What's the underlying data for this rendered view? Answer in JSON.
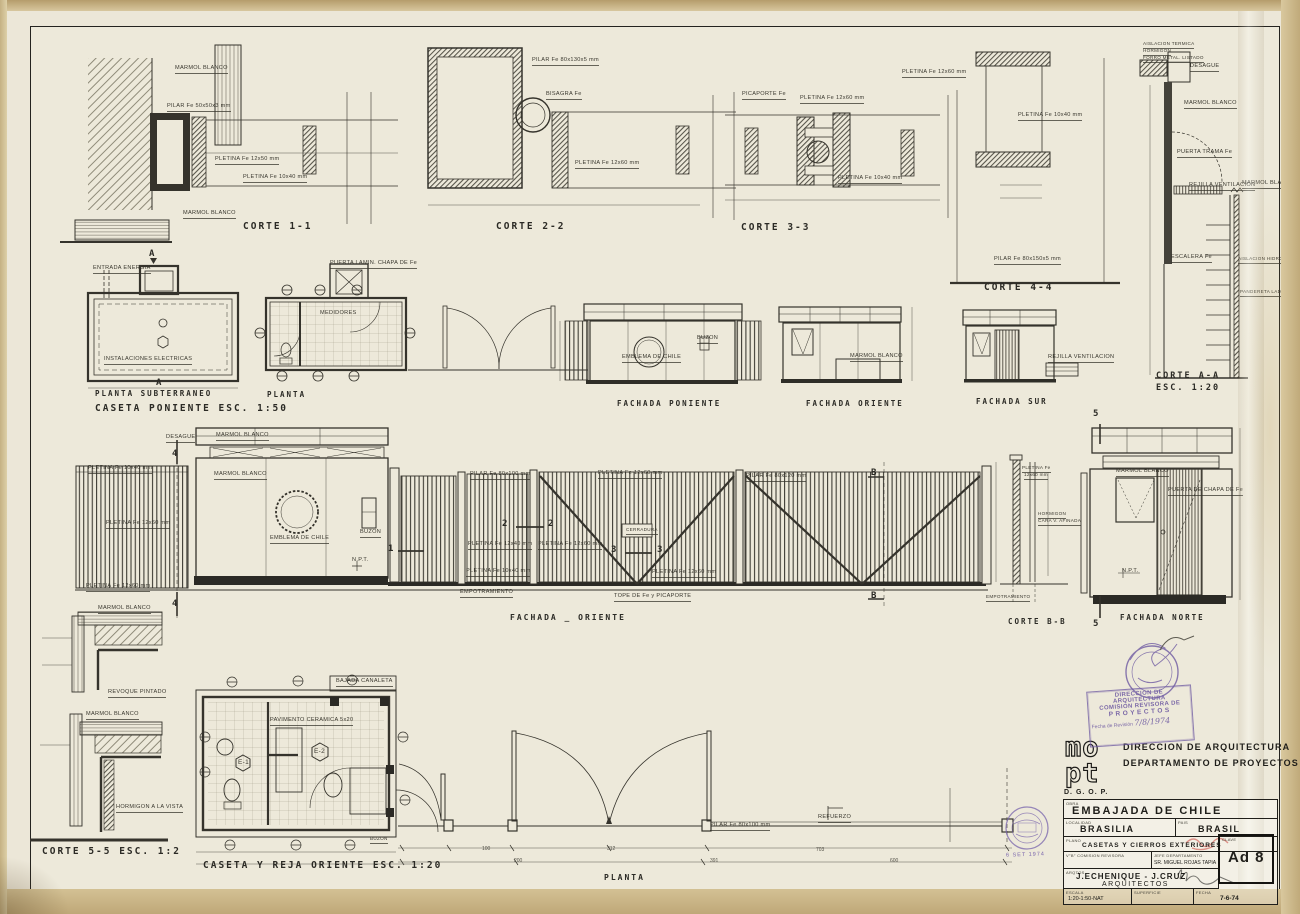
{
  "sheet": {
    "titles": [
      {
        "text": "CORTE 1-1",
        "x": 243,
        "y": 222
      },
      {
        "text": "CORTE 2-2",
        "x": 496,
        "y": 222
      },
      {
        "text": "CORTE 3-3",
        "x": 741,
        "y": 223
      },
      {
        "text": "CORTE 4-4",
        "x": 984,
        "y": 283
      },
      {
        "text": "CORTE A-A",
        "x": 1156,
        "y": 372,
        "size": 8.5
      },
      {
        "text": "ESC. 1:20",
        "x": 1156,
        "y": 384,
        "size": 8.5
      },
      {
        "text": "PLANTA SUBTERRANEO",
        "x": 95,
        "y": 390,
        "size": 7.5
      },
      {
        "text": "CASETA PONIENTE   ESC. 1:50",
        "x": 95,
        "y": 404
      },
      {
        "text": "PLANTA",
        "x": 267,
        "y": 391,
        "size": 7.5
      },
      {
        "text": "FACHADA PONIENTE",
        "x": 617,
        "y": 400,
        "size": 7.5
      },
      {
        "text": "FACHADA ORIENTE",
        "x": 806,
        "y": 400,
        "size": 7.5
      },
      {
        "text": "FACHADA SUR",
        "x": 976,
        "y": 398,
        "size": 7.5
      },
      {
        "text": "FACHADA _ ORIENTE",
        "x": 510,
        "y": 614,
        "size": 8
      },
      {
        "text": "CORTE B-B",
        "x": 1008,
        "y": 618,
        "size": 7.5
      },
      {
        "text": "FACHADA NORTE",
        "x": 1120,
        "y": 614,
        "size": 7.5
      },
      {
        "text": "CORTE 5-5  ESC. 1:2",
        "x": 42,
        "y": 847
      },
      {
        "text": "CASETA Y REJA ORIENTE   ESC. 1:20",
        "x": 203,
        "y": 861
      },
      {
        "text": "PLANTA",
        "x": 604,
        "y": 874,
        "size": 8
      }
    ],
    "annotations": [
      {
        "text": "MARMOL BLANCO",
        "x": 175,
        "y": 66
      },
      {
        "text": "PILAR Fe 50x50x3 mm",
        "x": 167,
        "y": 104
      },
      {
        "text": "PLETINA Fe 12x50 mm",
        "x": 215,
        "y": 157
      },
      {
        "text": "PLETINA Fe 10x40 mm",
        "x": 243,
        "y": 175
      },
      {
        "text": "MARMOL BLANCO",
        "x": 183,
        "y": 211
      },
      {
        "text": "PILAR Fe 80x130x5 mm",
        "x": 532,
        "y": 58
      },
      {
        "text": "BISAGRA Fe",
        "x": 546,
        "y": 92
      },
      {
        "text": "PLETINA Fe 12x60 mm",
        "x": 575,
        "y": 161
      },
      {
        "text": "PICAPORTE Fe",
        "x": 742,
        "y": 92
      },
      {
        "text": "PLETINA Fe 12x60 mm",
        "x": 800,
        "y": 96
      },
      {
        "text": "PLETINA Fe 10x40 mm",
        "x": 838,
        "y": 176
      },
      {
        "text": "PLETINA Fe 12x60 mm",
        "x": 902,
        "y": 70
      },
      {
        "text": "PLETINA Fe 10x40 mm",
        "x": 1018,
        "y": 113
      },
      {
        "text": "PILAR Fe 80x150x5 mm",
        "x": 994,
        "y": 257
      },
      {
        "text": "AISLACION TERMICA",
        "x": 1143,
        "y": 42,
        "size": 4.6
      },
      {
        "text": "HORMIGON",
        "x": 1143,
        "y": 49,
        "size": 4.6
      },
      {
        "text": "FORRO METAL. LISTADO",
        "x": 1143,
        "y": 56,
        "size": 4.6
      },
      {
        "text": "DESAGUE",
        "x": 1190,
        "y": 64
      },
      {
        "text": "MARMOL BLANCO",
        "x": 1184,
        "y": 101
      },
      {
        "text": "PUERTA TRAMA Fe",
        "x": 1177,
        "y": 150
      },
      {
        "text": "REJILLA VENTILACION",
        "x": 1189,
        "y": 183
      },
      {
        "text": "MARMOL BLANCO",
        "x": 1242,
        "y": 181
      },
      {
        "text": "ESCALERA Fe",
        "x": 1171,
        "y": 255
      },
      {
        "text": "AISLACION HIDROFUGA",
        "x": 1238,
        "y": 257,
        "size": 4.6
      },
      {
        "text": "PANDERETA LADRILLO",
        "x": 1240,
        "y": 290,
        "size": 4.6
      },
      {
        "text": "ENTRADA ENERGIA",
        "x": 93,
        "y": 266
      },
      {
        "text": "INSTALACIONES ELECTRICAS",
        "x": 104,
        "y": 357
      },
      {
        "text": "PUERTA LAMIN. CHAPA DE Fe",
        "x": 330,
        "y": 261
      },
      {
        "text": "MEDIDORES",
        "x": 320,
        "y": 311,
        "u": 0
      },
      {
        "text": "EMBLEMA DE CHILE",
        "x": 622,
        "y": 355
      },
      {
        "text": "BUZON",
        "x": 697,
        "y": 336
      },
      {
        "text": "MARMOL BLANCO",
        "x": 850,
        "y": 354
      },
      {
        "text": "REJILLA VENTILACION",
        "x": 1048,
        "y": 355
      },
      {
        "text": "DESAGUE",
        "x": 166,
        "y": 435
      },
      {
        "text": "MARMOL BLANCO",
        "x": 216,
        "y": 433
      },
      {
        "text": "PLETINA Fe 10x40 mm",
        "x": 88,
        "y": 466
      },
      {
        "text": "PLETINA Fe 12x60 mm",
        "x": 106,
        "y": 521
      },
      {
        "text": "PLETINA Fe 12x60 mm",
        "x": 86,
        "y": 584
      },
      {
        "text": "MARMOL BLANCO",
        "x": 214,
        "y": 472
      },
      {
        "text": "EMBLEMA DE CHILE",
        "x": 270,
        "y": 536
      },
      {
        "text": "BUZON",
        "x": 360,
        "y": 530
      },
      {
        "text": "N.P.T.",
        "x": 352,
        "y": 558,
        "u": 0
      },
      {
        "text": "PILAR Fe 80x100 mm",
        "x": 470,
        "y": 472
      },
      {
        "text": "PLETINA Fe 12x60 mm",
        "x": 598,
        "y": 471
      },
      {
        "text": "PILAR Fe 80x120 mm",
        "x": 746,
        "y": 474
      },
      {
        "text": "CERRADURA",
        "x": 626,
        "y": 528,
        "size": 4.6
      },
      {
        "text": "PLETINA Fe 12x40 mm",
        "x": 468,
        "y": 542
      },
      {
        "text": "PLETINA Fe 12x60 mm",
        "x": 538,
        "y": 542
      },
      {
        "text": "PLETINA Fe 10x40 mm",
        "x": 466,
        "y": 569
      },
      {
        "text": "PLETINA Fe 12x60 mm",
        "x": 652,
        "y": 570
      },
      {
        "text": "EMPOTRAMIENTO",
        "x": 460,
        "y": 590
      },
      {
        "text": "TOPE DE Fe y PICAPORTE",
        "x": 614,
        "y": 594
      },
      {
        "text": "PLETINA Fe",
        "x": 1022,
        "y": 466,
        "size": 4.6
      },
      {
        "text": "12x60 mm",
        "x": 1024,
        "y": 473,
        "size": 4.6
      },
      {
        "text": "HORMIGON",
        "x": 1038,
        "y": 512,
        "size": 4.6
      },
      {
        "text": "CARA V. AFINADA",
        "x": 1038,
        "y": 519,
        "size": 4.6
      },
      {
        "text": "EMPOTRAMIENTO",
        "x": 986,
        "y": 595,
        "size": 4.6
      },
      {
        "text": "MARMOL BLANCO",
        "x": 1116,
        "y": 469
      },
      {
        "text": "PUERTA DE CHAPA DE Fe",
        "x": 1168,
        "y": 488
      },
      {
        "text": "N.P.T.",
        "x": 1122,
        "y": 569,
        "u": 0
      },
      {
        "text": "MARMOL BLANCO",
        "x": 98,
        "y": 606
      },
      {
        "text": "REVOQUE PINTADO",
        "x": 108,
        "y": 690
      },
      {
        "text": "MARMOL BLANCO",
        "x": 86,
        "y": 712
      },
      {
        "text": "HORMIGON A LA VISTA",
        "x": 116,
        "y": 805
      },
      {
        "text": "BAJADA CANALETA",
        "x": 336,
        "y": 679
      },
      {
        "text": "PAVIMENTO CERAMICA 5x20",
        "x": 270,
        "y": 718
      },
      {
        "text": "E-1",
        "x": 238,
        "y": 760,
        "u": 0,
        "size": 6.5
      },
      {
        "text": "E-2",
        "x": 314,
        "y": 749,
        "u": 0,
        "size": 6.5
      },
      {
        "text": "BUZON",
        "x": 370,
        "y": 837,
        "size": 4.6
      },
      {
        "text": "PILAR Fe 80x100 mm",
        "x": 710,
        "y": 823
      },
      {
        "text": "REFUERZO",
        "x": 818,
        "y": 815
      }
    ],
    "markers": [
      {
        "text": "A",
        "x": 149,
        "y": 250
      },
      {
        "text": "A",
        "x": 156,
        "y": 379
      },
      {
        "text": "4",
        "x": 172,
        "y": 450
      },
      {
        "text": "4",
        "x": 172,
        "y": 600
      },
      {
        "text": "1",
        "x": 388,
        "y": 545
      },
      {
        "text": "2",
        "x": 502,
        "y": 520
      },
      {
        "text": "2",
        "x": 548,
        "y": 520
      },
      {
        "text": "3",
        "x": 611,
        "y": 546
      },
      {
        "text": "3",
        "x": 657,
        "y": 546
      },
      {
        "text": "B",
        "x": 871,
        "y": 469
      },
      {
        "text": "B",
        "x": 871,
        "y": 592
      },
      {
        "text": "5",
        "x": 1093,
        "y": 410
      },
      {
        "text": "5",
        "x": 1093,
        "y": 620
      }
    ],
    "dims": [
      {
        "text": "100",
        "x": 482,
        "y": 847
      },
      {
        "text": "200",
        "x": 514,
        "y": 859
      },
      {
        "text": "312",
        "x": 607,
        "y": 847
      },
      {
        "text": "391",
        "x": 710,
        "y": 859
      },
      {
        "text": "703",
        "x": 816,
        "y": 848
      },
      {
        "text": "600",
        "x": 890,
        "y": 859
      }
    ],
    "title_block": {
      "logo_line1": "mo",
      "logo_line2": "pt",
      "org_abbr": "D. G. O. P.",
      "dept_line1": "DIRECCION  DE  ARQUITECTURA",
      "dept_line2": "DEPARTAMENTO  DE  PROYECTOS",
      "obra_label": "OBRA",
      "obra": "EMBAJADA DE CHILE",
      "localidad_label": "LOCALIDAD",
      "localidad": "BRASILIA",
      "pais_label": "PAIS",
      "pais": "BRASIL",
      "plano_label": "PLANO",
      "plano": "CASETAS Y CIERROS EXTERIORES",
      "vb_label": "V°B° COMISION REVISORA",
      "jefe_label": "JEFE DEPARTAMENTO",
      "jefe": "SR. MIGUEL ROJAS TAPIA",
      "arqto_label": "ARQTOS.",
      "arquitectos": "J.ECHENIQUE - J.CRUZ",
      "arquitectos2": "ARQUITECTOS",
      "clave_label": "CLAVE",
      "clave": "Ad 8",
      "escala_label": "ESCALA",
      "escala": "1:20-1:50-NAT",
      "superficie_label": "SUPERFICIE",
      "fecha_label": "FECHA",
      "fecha": "7-6-74"
    },
    "stamps": {
      "revision": {
        "line1": "DIRECCION DE ARQUITECTURA",
        "line2": "COMISION REVISORA DE",
        "line3": "PROYECTOS",
        "fecha_label": "Fecha de Revisión",
        "fecha_value": "7/8/1974"
      },
      "archive_date": "6 SET 1974"
    }
  }
}
